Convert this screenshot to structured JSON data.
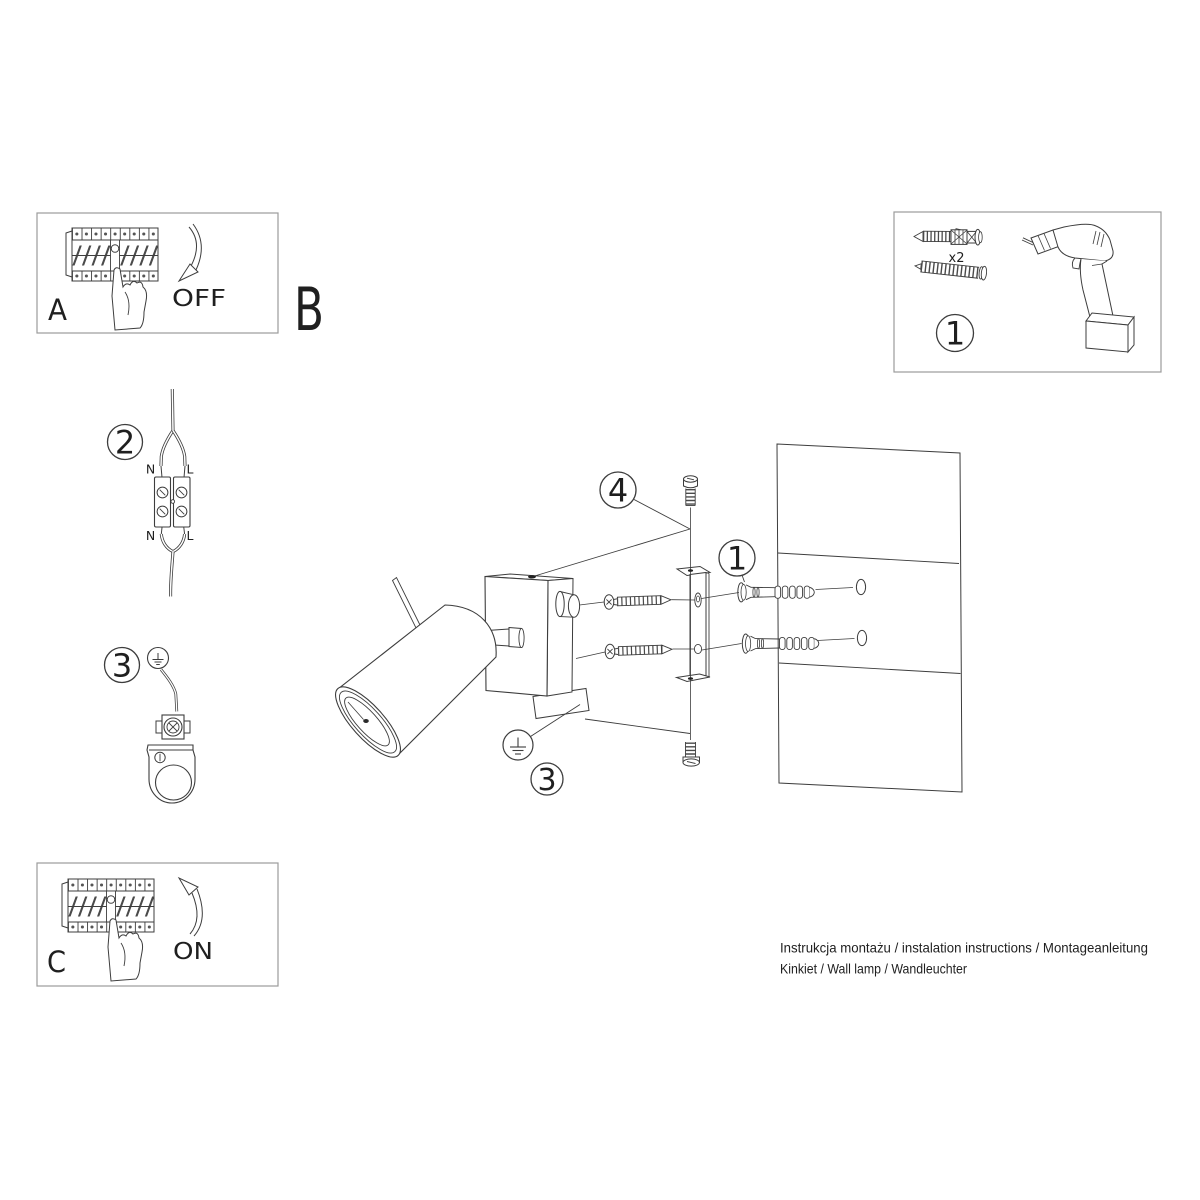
{
  "colors": {
    "background": "#ffffff",
    "line": "#3d3d3d",
    "panel_border": "#9b9b9b",
    "text": "#1f1f1f"
  },
  "panel_a": {
    "letter": "A",
    "action_label": "OFF"
  },
  "section_b": {
    "letter": "B"
  },
  "panel_c": {
    "letter": "C",
    "action_label": "ON"
  },
  "panel_tools": {
    "callout_number": "1",
    "quantity_label": "x2"
  },
  "step_wiring": {
    "callout_number": "2",
    "terminal_labels": {
      "top_left": "N",
      "top_right": "L",
      "bottom_left": "N",
      "bottom_right": "L"
    }
  },
  "step_ground": {
    "callout_number": "3"
  },
  "assembly": {
    "callout_screw": "4",
    "callout_plugs": "1",
    "callout_ground": "3"
  },
  "footer": {
    "line1": "Instrukcja montażu / instalation instructions / Montageanleitung",
    "line2": "Kinkiet / Wall lamp / Wandleuchter"
  }
}
